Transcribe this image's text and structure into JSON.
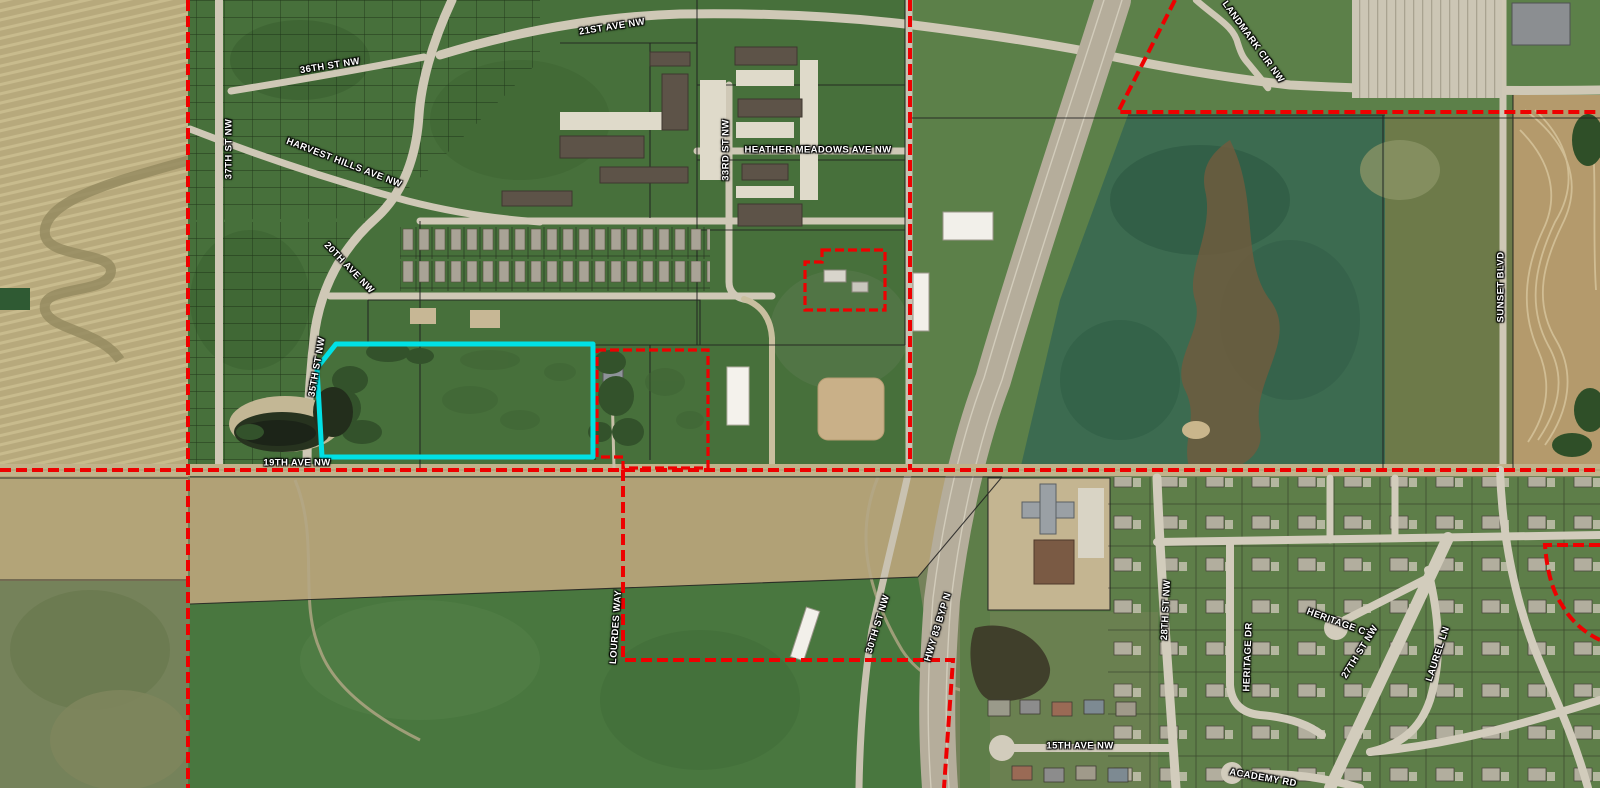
{
  "map": {
    "type": "aerial-parcel-boundary-map",
    "street_labels": [
      {
        "id": "21st-ave-nw",
        "text": "21ST AVE NW",
        "x": 612,
        "y": 27,
        "rot": -9
      },
      {
        "id": "36th-st-nw",
        "text": "36TH ST NW",
        "x": 330,
        "y": 66,
        "rot": -9
      },
      {
        "id": "37th-st-nw",
        "text": "37TH ST NW",
        "x": 229,
        "y": 149,
        "rot": -90
      },
      {
        "id": "harvest-hills-ave-nw",
        "text": "HARVEST HILLS AVE NW",
        "x": 344,
        "y": 163,
        "rot": 21
      },
      {
        "id": "20th-ave-nw",
        "text": "20TH AVE NW",
        "x": 349,
        "y": 268,
        "rot": 46
      },
      {
        "id": "35th-st-nw",
        "text": "35TH ST NW",
        "x": 317,
        "y": 367,
        "rot": -80
      },
      {
        "id": "33rd-st-nw",
        "text": "33RD ST NW",
        "x": 726,
        "y": 150,
        "rot": -90
      },
      {
        "id": "heather-meadows-ave-nw",
        "text": "HEATHER MEADOWS AVE NW",
        "x": 818,
        "y": 150,
        "rot": 0
      },
      {
        "id": "landmark-cir-nw",
        "text": "LANDMARK CIR NW",
        "x": 1253,
        "y": 42,
        "rot": 54
      },
      {
        "id": "sunset-blvd",
        "text": "SUNSET BLVD",
        "x": 1501,
        "y": 287,
        "rot": -90
      },
      {
        "id": "19th-ave-nw",
        "text": "19TH AVE NW",
        "x": 297,
        "y": 463,
        "rot": 0
      },
      {
        "id": "lourdes-way",
        "text": "LOURDES WAY",
        "x": 616,
        "y": 627,
        "rot": -86
      },
      {
        "id": "30th-st-nw",
        "text": "30TH ST NW",
        "x": 878,
        "y": 624,
        "rot": -73
      },
      {
        "id": "hwy-83-byp-n",
        "text": "HWY 83 BYP N",
        "x": 938,
        "y": 627,
        "rot": -73
      },
      {
        "id": "28th-st-nw",
        "text": "28TH ST NW",
        "x": 1166,
        "y": 610,
        "rot": -87
      },
      {
        "id": "heritage-dr",
        "text": "HERITAGE DR",
        "x": 1248,
        "y": 657,
        "rot": -88
      },
      {
        "id": "heritage-ct",
        "text": "HERITAGE CT",
        "x": 1339,
        "y": 623,
        "rot": 20
      },
      {
        "id": "27th-st-nw",
        "text": "27TH ST NW",
        "x": 1360,
        "y": 652,
        "rot": -58
      },
      {
        "id": "laurel-ln",
        "text": "LAUREL LN",
        "x": 1438,
        "y": 654,
        "rot": -72
      },
      {
        "id": "15th-ave-nw",
        "text": "15TH AVE NW",
        "x": 1080,
        "y": 746,
        "rot": 0
      },
      {
        "id": "academy-rd",
        "text": "ACADEMY RD",
        "x": 1263,
        "y": 778,
        "rot": 10
      }
    ],
    "overlays": {
      "boundary_color": "#ee0000",
      "boundary_style": "dashed",
      "highlight_color": "#00e1e6",
      "parcel_line_color": "#1c1c1c"
    }
  }
}
